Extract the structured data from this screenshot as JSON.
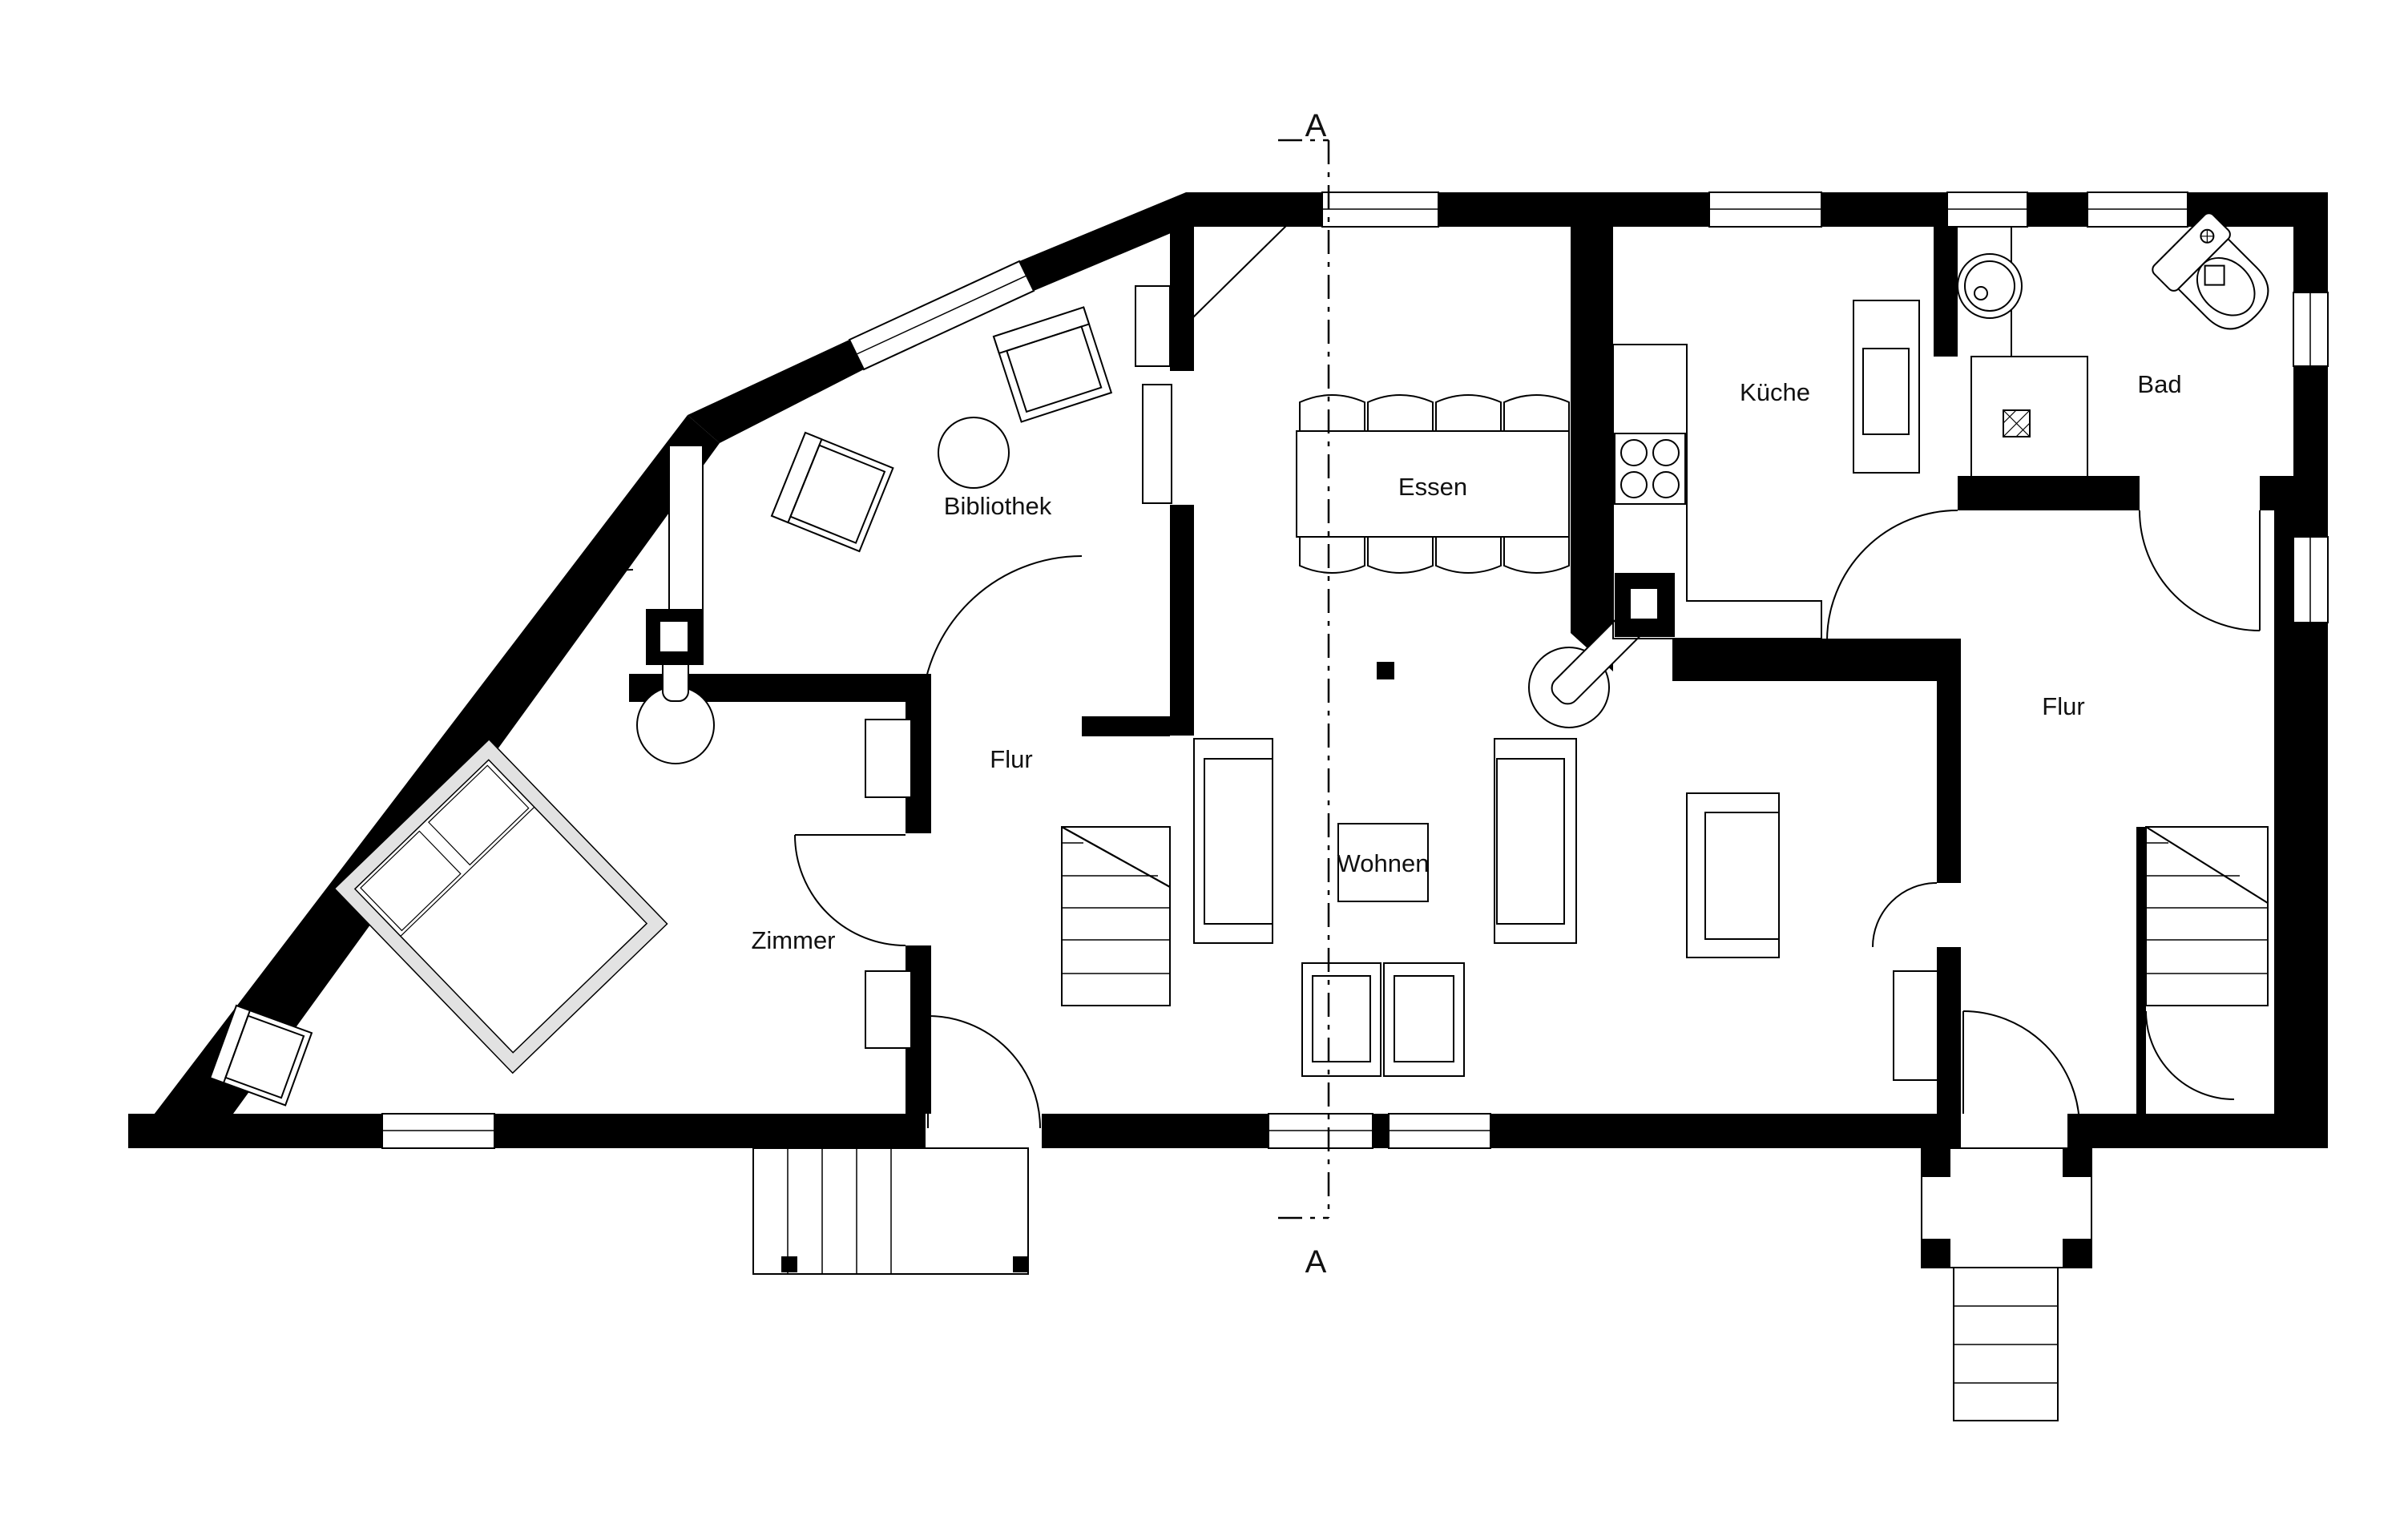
{
  "plan": {
    "type": "floorplan",
    "section_marker": "A",
    "rooms": [
      {
        "id": "bibliothek",
        "label": "Bibliothek"
      },
      {
        "id": "essen",
        "label": "Essen"
      },
      {
        "id": "kueche",
        "label": "Küche"
      },
      {
        "id": "bad",
        "label": "Bad"
      },
      {
        "id": "flur_right",
        "label": "Flur"
      },
      {
        "id": "flur_left",
        "label": "Flur"
      },
      {
        "id": "zimmer",
        "label": "Zimmer"
      },
      {
        "id": "wohnen",
        "label": "Wohnen"
      }
    ],
    "features": [
      "dining-table-8-chairs",
      "library-round-table-2-armchairs",
      "double-bed",
      "two-sofas-two-armchairs-coffee-table",
      "kitchen-L-counter-4-burner-stove",
      "bathroom-toilet-washbasin-shower",
      "two-staircases",
      "two-entry-porches",
      "two-tiled-stoves-with-chimneys",
      "section-line-A-A"
    ],
    "colors": {
      "wall": "#000000",
      "background": "#ffffff",
      "line": "#000000",
      "bed_frame": "#e2e2e2"
    }
  }
}
